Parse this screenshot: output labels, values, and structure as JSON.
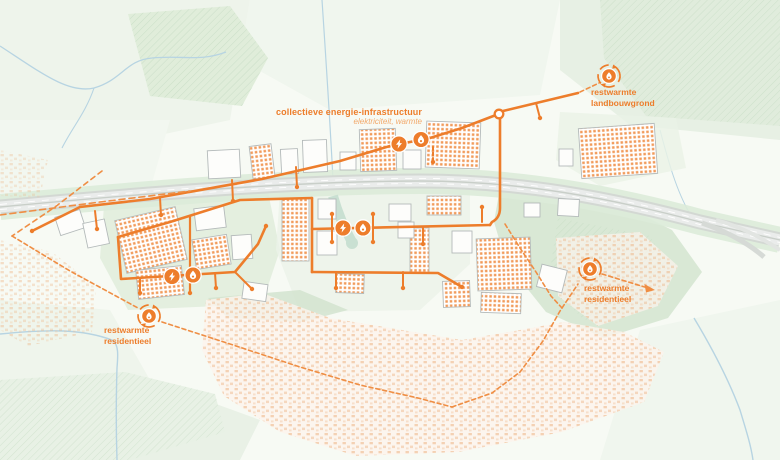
{
  "map": {
    "legend": {
      "title": "collectieve energie-infrastructuur",
      "subtitle": "elektriciteit, warmte"
    },
    "labels": {
      "landbouwgrond": {
        "line1": "restwarmte",
        "line2": "landbouwgrond"
      },
      "residentieel_west": {
        "line1": "restwarmte",
        "line2": "residentieel"
      },
      "residentieel_oost": {
        "line1": "restwarmte",
        "line2": "residentieel"
      }
    },
    "icons": {
      "electricity": "lightning-bolt-in-circle",
      "heat": "flame-in-circle",
      "residual_heat": "flame-in-circle-with-dashed-circular-arrow",
      "junction": "open-node-circle",
      "route_arrow": "dashed-arrow-right"
    },
    "colors": {
      "accent_orange": "#ed7d2b",
      "light_orange": "#f2a96b",
      "solar_orange": "#ef8a3e",
      "village_orange": "#ecae7c",
      "water_blue": "#b7d4e2",
      "field_green": "#e6f0e3",
      "forest_green": "#cfe2cd",
      "highway_gray": "#d3d8d3"
    }
  }
}
